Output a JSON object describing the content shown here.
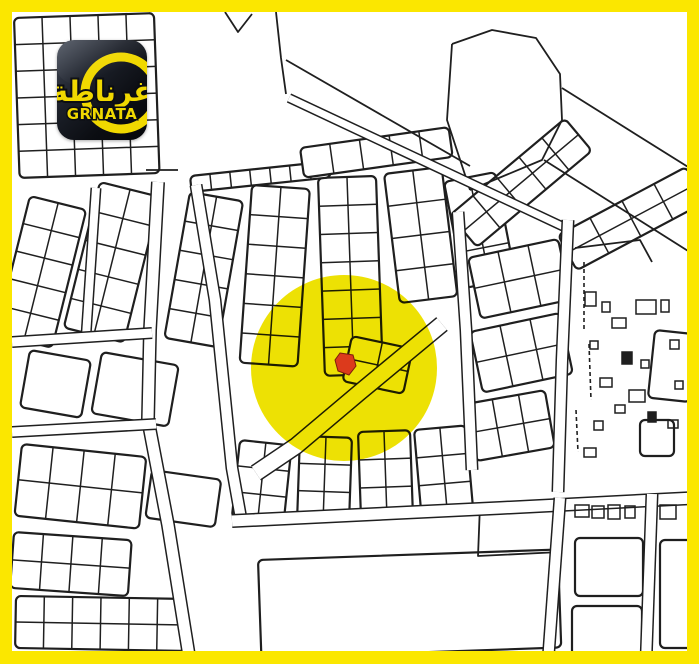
{
  "colors": {
    "frame_yellow": "#FBE700",
    "map_background": "#FFFFFF",
    "map_line": "#1f1f1f",
    "highlight_yellow": "#EDE104",
    "marker_red": "#DC3A1C",
    "marker_outline": "#7e1c0c",
    "logo_background_dark": "#0B0D12",
    "logo_yellow": "#F0D800"
  },
  "logo": {
    "arabic": "غرناطة",
    "latin": "GRNATA"
  },
  "map": {
    "highlight": {
      "cx": 344,
      "cy": 368,
      "r": 93
    },
    "marker_points": "340,353 353,355 356,366 349,375 338,371 335,360",
    "blocks": [
      [
        14,
        18,
        140,
        160,
        5,
        6,
        -2
      ],
      [
        30,
        196,
        58,
        142,
        2,
        5,
        14
      ],
      [
        100,
        182,
        62,
        150,
        2,
        5,
        14
      ],
      [
        30,
        350,
        62,
        58,
        1,
        1,
        10
      ],
      [
        102,
        352,
        78,
        62,
        1,
        1,
        10
      ],
      [
        22,
        444,
        125,
        72,
        4,
        2,
        6
      ],
      [
        152,
        470,
        70,
        48,
        1,
        1,
        8
      ],
      [
        14,
        532,
        118,
        56,
        4,
        2,
        4
      ],
      [
        16,
        596,
        170,
        52,
        6,
        2,
        1
      ],
      [
        190,
        192,
        54,
        148,
        2,
        5,
        10
      ],
      [
        252,
        185,
        58,
        178,
        2,
        6,
        4
      ],
      [
        318,
        178,
        58,
        198,
        2,
        7,
        -2
      ],
      [
        384,
        174,
        58,
        130,
        2,
        4,
        -7
      ],
      [
        444,
        182,
        52,
        108,
        2,
        3,
        -11
      ],
      [
        190,
        176,
        140,
        16,
        7,
        1,
        -6
      ],
      [
        300,
        148,
        150,
        30,
        5,
        1,
        -8
      ],
      [
        352,
        336,
        62,
        46,
        2,
        2,
        12
      ],
      [
        240,
        440,
        52,
        78,
        2,
        3,
        6
      ],
      [
        300,
        436,
        52,
        82,
        2,
        3,
        2
      ],
      [
        358,
        432,
        52,
        84,
        2,
        3,
        -2
      ],
      [
        414,
        430,
        52,
        84,
        2,
        3,
        -5
      ],
      [
        450,
        215,
        150,
        42,
        5,
        2,
        -40
      ],
      [
        558,
        235,
        145,
        40,
        4,
        2,
        -28
      ],
      [
        468,
        258,
        92,
        62,
        3,
        2,
        -12
      ],
      [
        470,
        332,
        92,
        62,
        3,
        2,
        -12
      ],
      [
        466,
        404,
        80,
        58,
        3,
        2,
        -10
      ],
      [
        655,
        330,
        42,
        68,
        1,
        1,
        6
      ],
      [
        640,
        420,
        34,
        36,
        1,
        1,
        0
      ],
      [
        258,
        560,
        300,
        98,
        1,
        1,
        -2
      ],
      [
        575,
        538,
        68,
        58,
        1,
        1,
        0
      ],
      [
        572,
        606,
        70,
        56,
        1,
        1,
        0
      ],
      [
        660,
        540,
        38,
        108,
        1,
        1,
        0
      ]
    ],
    "roads": [
      {
        "pts": [
          [
            158,
            182
          ],
          [
            150,
            330
          ],
          [
            148,
            420
          ],
          [
            168,
            525
          ],
          [
            190,
            662
          ]
        ],
        "w": 11
      },
      {
        "pts": [
          [
            196,
            185
          ],
          [
            215,
            300
          ],
          [
            232,
            468
          ],
          [
            242,
            524
          ]
        ],
        "w": 10
      },
      {
        "pts": [
          [
            96,
            188
          ],
          [
            86,
            336
          ]
        ],
        "w": 8
      },
      {
        "pts": [
          [
            12,
            342
          ],
          [
            152,
            333
          ]
        ],
        "w": 9
      },
      {
        "pts": [
          [
            12,
            432
          ],
          [
            156,
            424
          ]
        ],
        "w": 9
      },
      {
        "pts": [
          [
            232,
            521
          ],
          [
            500,
            508
          ],
          [
            694,
            498
          ]
        ],
        "w": 11
      },
      {
        "pts": [
          [
            289,
            98
          ],
          [
            566,
            228
          ]
        ],
        "w": 7
      },
      {
        "pts": [
          [
            442,
            324
          ],
          [
            360,
            392
          ],
          [
            296,
            446
          ],
          [
            256,
            473
          ]
        ],
        "w": 15
      },
      {
        "pts": [
          [
            458,
            212
          ],
          [
            466,
            330
          ],
          [
            472,
            470
          ]
        ],
        "w": 10
      },
      {
        "pts": [
          [
            568,
            220
          ],
          [
            562,
            360
          ],
          [
            558,
            492
          ]
        ],
        "w": 10
      },
      {
        "pts": [
          [
            560,
            498
          ],
          [
            548,
            662
          ]
        ],
        "w": 10
      },
      {
        "pts": [
          [
            652,
            494
          ],
          [
            646,
            662
          ]
        ],
        "w": 10
      }
    ],
    "lines": [
      [
        [
          225,
          12
        ],
        [
          238,
          32
        ],
        [
          252,
          14
        ]
      ],
      [
        [
          276,
          12
        ],
        [
          281,
          58
        ],
        [
          286,
          94
        ]
      ],
      [
        [
          286,
          60
        ],
        [
          470,
          166
        ]
      ],
      [
        [
          452,
          44
        ],
        [
          492,
          30
        ],
        [
          536,
          38
        ],
        [
          560,
          74
        ],
        [
          562,
          120
        ],
        [
          542,
          160
        ],
        [
          470,
          190
        ]
      ],
      [
        [
          452,
          44
        ],
        [
          447,
          120
        ],
        [
          470,
          190
        ]
      ],
      [
        [
          562,
          88
        ],
        [
          696,
          172
        ]
      ],
      [
        [
          544,
          160
        ],
        [
          696,
          256
        ]
      ],
      [
        [
          480,
          505
        ],
        [
          478,
          556
        ],
        [
          560,
          552
        ]
      ],
      [
        [
          146,
          170
        ],
        [
          178,
          170
        ]
      ],
      [
        [
          575,
          248
        ],
        [
          640,
          240
        ],
        [
          652,
          262
        ]
      ]
    ],
    "dashes": [
      [
        [
          584,
          262
        ],
        [
          584,
          332
        ]
      ],
      [
        [
          589,
          344
        ],
        [
          591,
          400
        ]
      ],
      [
        [
          576,
          410
        ],
        [
          578,
          452
        ]
      ]
    ],
    "buildings": [
      [
        585,
        292,
        11,
        14,
        0
      ],
      [
        602,
        302,
        8,
        10,
        0
      ],
      [
        612,
        318,
        14,
        10,
        0
      ],
      [
        590,
        341,
        8,
        8,
        0
      ],
      [
        622,
        352,
        10,
        12,
        1
      ],
      [
        641,
        360,
        8,
        8,
        0
      ],
      [
        600,
        378,
        12,
        9,
        0
      ],
      [
        629,
        390,
        16,
        12,
        0
      ],
      [
        615,
        405,
        10,
        8,
        0
      ],
      [
        648,
        412,
        8,
        10,
        1
      ],
      [
        594,
        421,
        9,
        9,
        0
      ],
      [
        661,
        300,
        8,
        12,
        0
      ],
      [
        668,
        420,
        10,
        8,
        0
      ],
      [
        675,
        381,
        8,
        8,
        0
      ],
      [
        584,
        448,
        12,
        9,
        0
      ],
      [
        636,
        300,
        20,
        14,
        0
      ],
      [
        575,
        505,
        14,
        12,
        0
      ],
      [
        592,
        506,
        12,
        12,
        0
      ],
      [
        608,
        505,
        12,
        14,
        0
      ],
      [
        625,
        506,
        10,
        12,
        0
      ],
      [
        660,
        505,
        16,
        14,
        0
      ],
      [
        670,
        340,
        9,
        9,
        0
      ]
    ]
  }
}
